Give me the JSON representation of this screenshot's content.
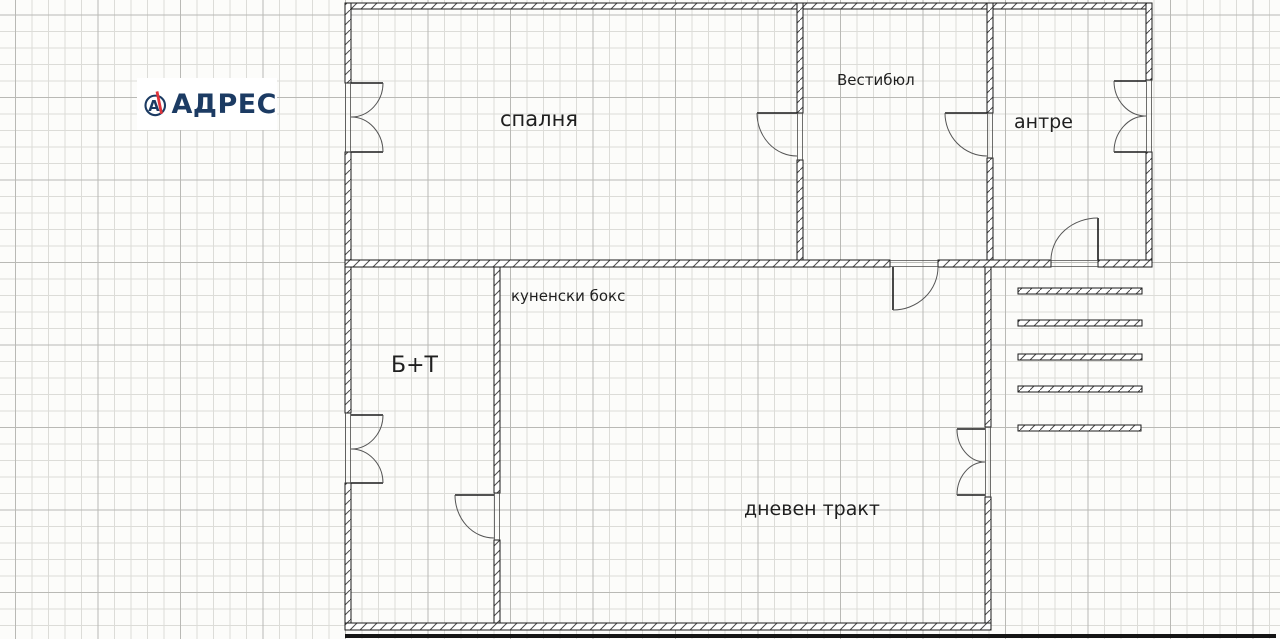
{
  "brand": {
    "name": "АДРЕС",
    "icon_letter": "А",
    "navy": "#1c3b63",
    "red": "#e0333a"
  },
  "plan": {
    "rooms": [
      {
        "id": "bedroom",
        "label": "спалня"
      },
      {
        "id": "vestibule",
        "label": "Вестибюл"
      },
      {
        "id": "antre",
        "label": "антре"
      },
      {
        "id": "kitchenette",
        "label": "куненски бокс"
      },
      {
        "id": "bath_toilet",
        "label": "Б+Т"
      },
      {
        "id": "living",
        "label": "дневен тракт"
      }
    ]
  }
}
